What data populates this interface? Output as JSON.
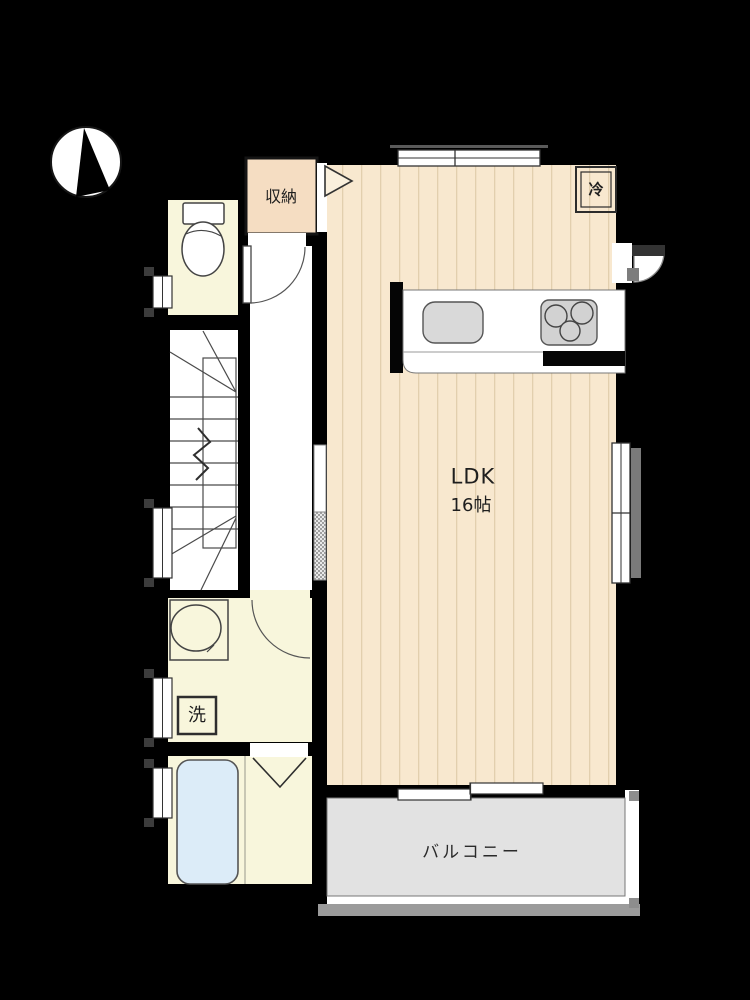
{
  "plan": {
    "type": "floor-plan",
    "labels": {
      "ldk": "LDK",
      "ldk_size": "16帖",
      "storage": "収納",
      "refrigerator": "冷",
      "washing_machine": "洗",
      "balcony": "バルコニー"
    },
    "icons": {
      "compass": "north-arrow-compass",
      "toilet": "toilet-fixture",
      "bathtub": "bathtub",
      "stairs": "staircase-with-break-line",
      "sink": "kitchen-sink",
      "stove": "three-burner-stove",
      "washbasin": "washbasin-oval"
    },
    "colors": {
      "background": "#000000",
      "wood_floor": "#f8e8cf",
      "wood_floor_stripe": "#e2cfae",
      "room_cream": "#f8f6dc",
      "storage_peach": "#f5ddc2",
      "bathtub_blue": "#dcecf8",
      "balcony_gray": "#e2e2e2",
      "railing_gray": "#9b9b9b",
      "fixture_gray": "#d6d6d6",
      "counter_white": "#ffffff",
      "line": "#3f3f3f"
    }
  }
}
